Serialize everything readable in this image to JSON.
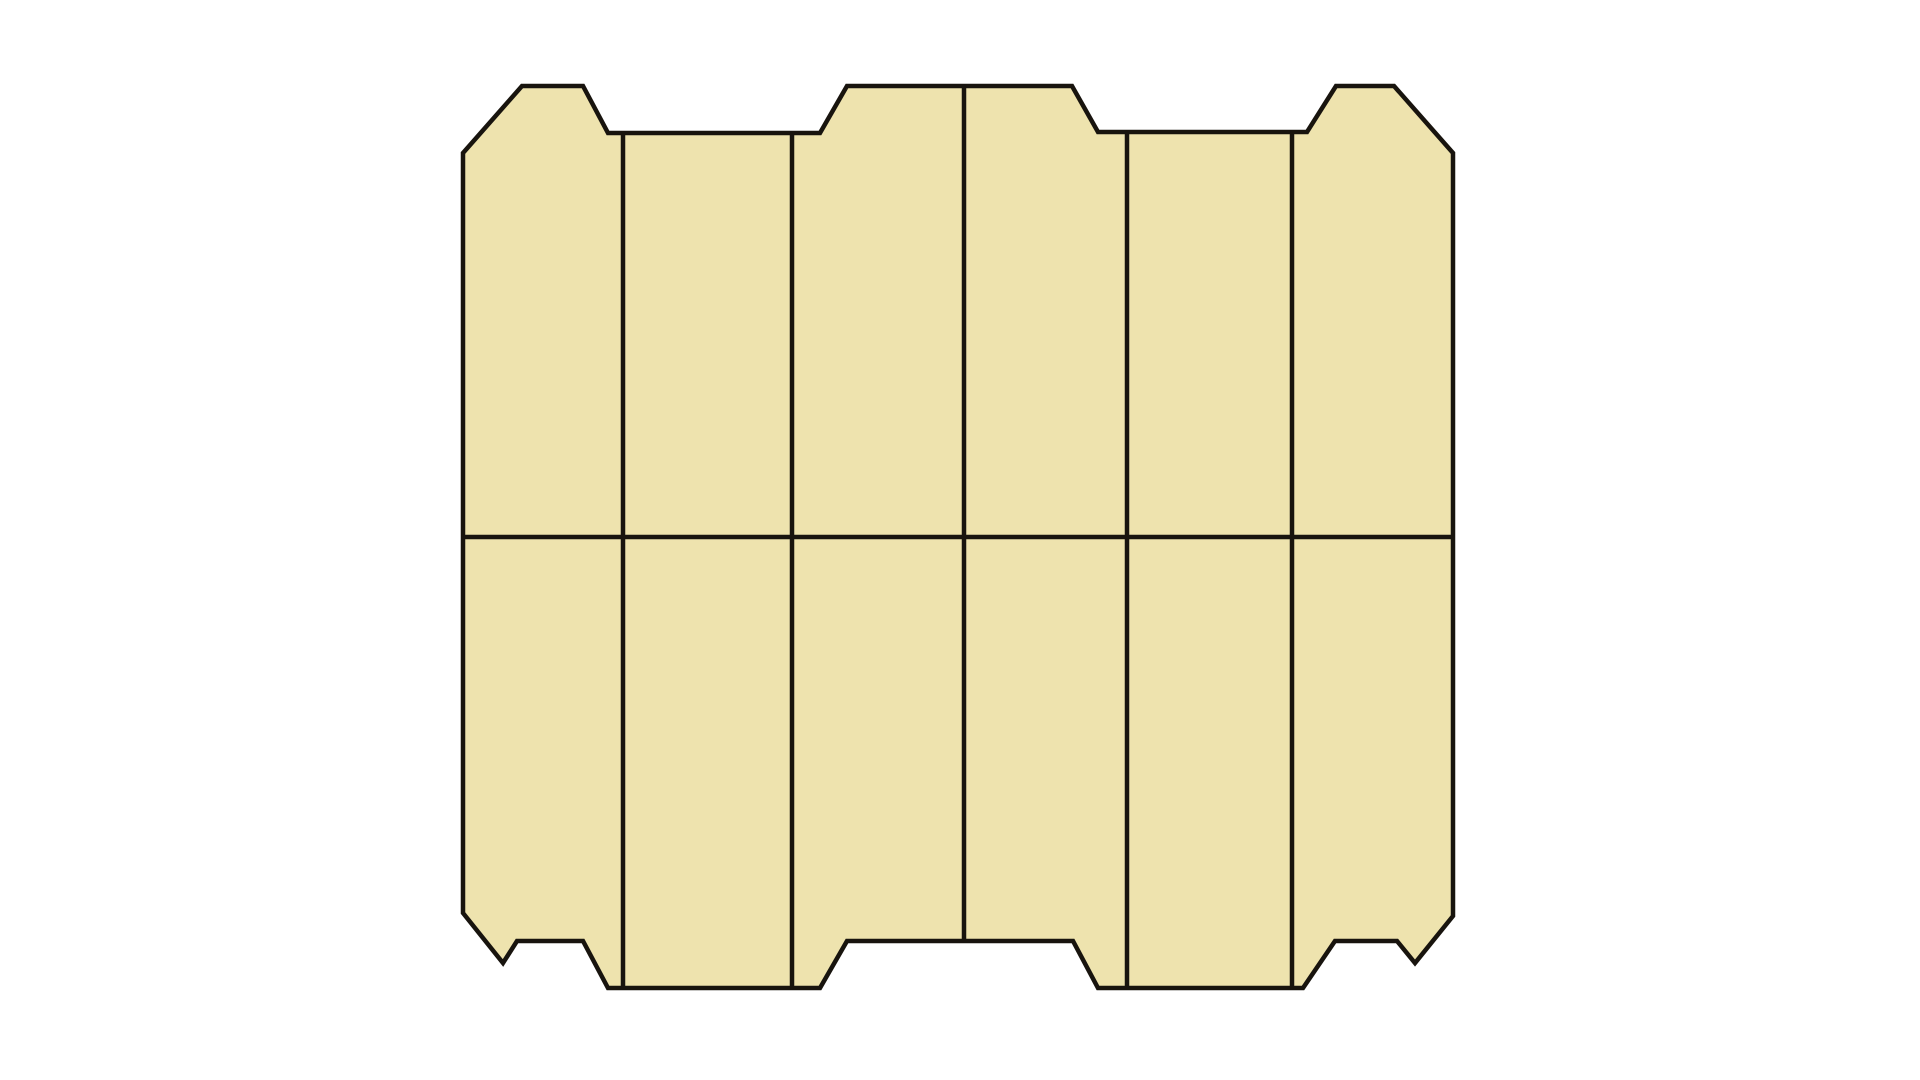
{
  "background_color": "#ffffff",
  "figure": {
    "kind": "segmented-panel-diagram",
    "canvas": {
      "width": 1920,
      "height": 1080
    },
    "fill": "#EEE3AE",
    "stroke": "#18140E",
    "stroke_width": 4.5,
    "grid": {
      "columns": 6,
      "rows": 2
    },
    "outline": [
      [
        463,
        153
      ],
      [
        522,
        86
      ],
      [
        583,
        86
      ],
      [
        608,
        133
      ],
      [
        820,
        133
      ],
      [
        847,
        86
      ],
      [
        1072,
        86
      ],
      [
        1098,
        132
      ],
      [
        1307,
        132
      ],
      [
        1336,
        86
      ],
      [
        1394,
        86
      ],
      [
        1453,
        153
      ],
      [
        1453,
        916
      ],
      [
        1415,
        963
      ],
      [
        1397,
        941
      ],
      [
        1335,
        941
      ],
      [
        1303,
        988
      ],
      [
        1098,
        988
      ],
      [
        1073,
        941
      ],
      [
        847,
        941
      ],
      [
        820,
        988
      ],
      [
        608,
        988
      ],
      [
        583,
        941
      ],
      [
        517,
        941
      ],
      [
        503,
        963
      ],
      [
        463,
        913
      ]
    ],
    "vertical_dividers": [
      {
        "x": 623,
        "y1": 133,
        "y2": 988
      },
      {
        "x": 792,
        "y1": 133,
        "y2": 988
      },
      {
        "x": 964,
        "y1": 86,
        "y2": 941
      },
      {
        "x": 1127,
        "y1": 132,
        "y2": 988
      },
      {
        "x": 1292,
        "y1": 132,
        "y2": 988
      }
    ],
    "horizontal_divider": {
      "y": 537,
      "x1": 463,
      "x2": 1453
    }
  }
}
